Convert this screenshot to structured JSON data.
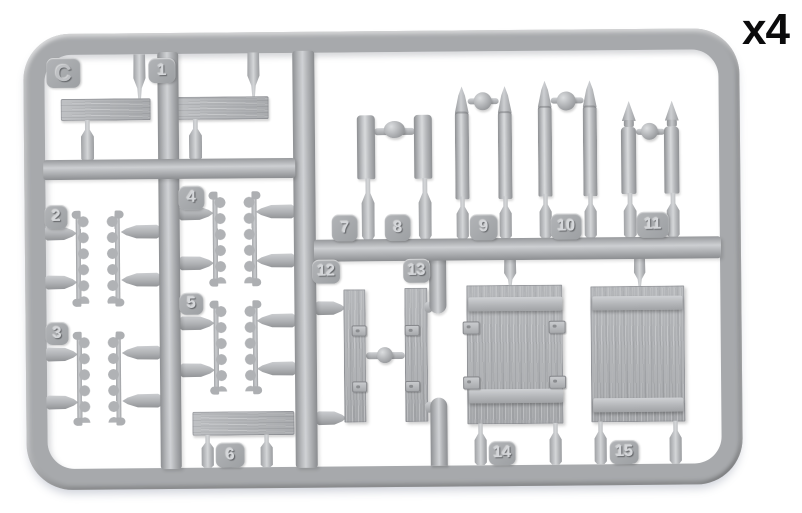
{
  "sprue": {
    "letter": "C",
    "quantity_label": "x4",
    "colors": {
      "plastic_base": "#aeb0b3",
      "plastic_highlight": "#d6d8da",
      "plastic_shadow": "#8a8c8f",
      "background": "#ffffff",
      "quantity_text": "#0b0b0c"
    }
  },
  "tabs": [
    {
      "label": "1"
    },
    {
      "label": "2"
    },
    {
      "label": "3"
    },
    {
      "label": "4"
    },
    {
      "label": "5"
    },
    {
      "label": "6"
    },
    {
      "label": "7"
    },
    {
      "label": "8"
    },
    {
      "label": "9"
    },
    {
      "label": "10"
    },
    {
      "label": "11"
    },
    {
      "label": "12"
    },
    {
      "label": "13"
    },
    {
      "label": "14"
    },
    {
      "label": "15"
    }
  ]
}
